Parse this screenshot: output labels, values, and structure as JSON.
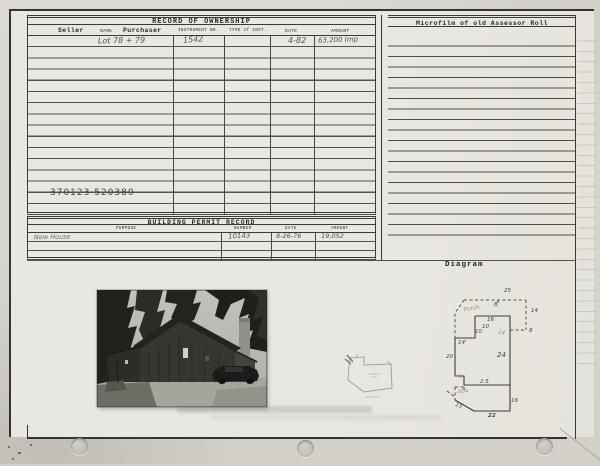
{
  "colors": {
    "card_bg": "#e9e7e1",
    "rule": "#3c3a34",
    "pencil": "#50505a",
    "faint_pencil": "#8e8c83"
  },
  "ownership": {
    "title": "RECORD OF OWNERSHIP",
    "headers": {
      "seller": "Seller",
      "name": "NAME",
      "purchaser": "Purchaser",
      "instrument": "INSTRUMENT NR.",
      "type": "TYPE of INST.",
      "date": "DATE",
      "amount": "AMOUNT"
    },
    "entry": {
      "lot": "Lot 78 + 79",
      "instrument": "1542",
      "date": "4-82",
      "amount": "63,200 Imp"
    },
    "parcel_numbers": "370123  520380"
  },
  "microfilm": {
    "title": "Microfilm of old Assessor Roll"
  },
  "permit": {
    "title": "BUILDING PERMIT RECORD",
    "headers": {
      "purpose": "PURPOSE",
      "number": "NUMBER",
      "date": "DATE",
      "amount": "AMOUNT"
    },
    "entry": {
      "purpose": "New House",
      "number": "10143",
      "date": "8-26-76",
      "amount": "19,052"
    }
  },
  "diagram": {
    "section_label": "Diagram",
    "dims": {
      "top_width": "25",
      "top_tick": "8",
      "porch": "Porch",
      "right_upper": "14",
      "upper_width": "16",
      "notch_a": "10",
      "notch_b": "10",
      "inner_faint": "14",
      "left_upper": "14'",
      "right_ext": "8",
      "left_mid": "20",
      "area": "24",
      "step_tick": "8",
      "step": "2.5",
      "scribble": "20/4",
      "diagonal": "15",
      "bottom": "22",
      "right_lower": "16"
    }
  }
}
